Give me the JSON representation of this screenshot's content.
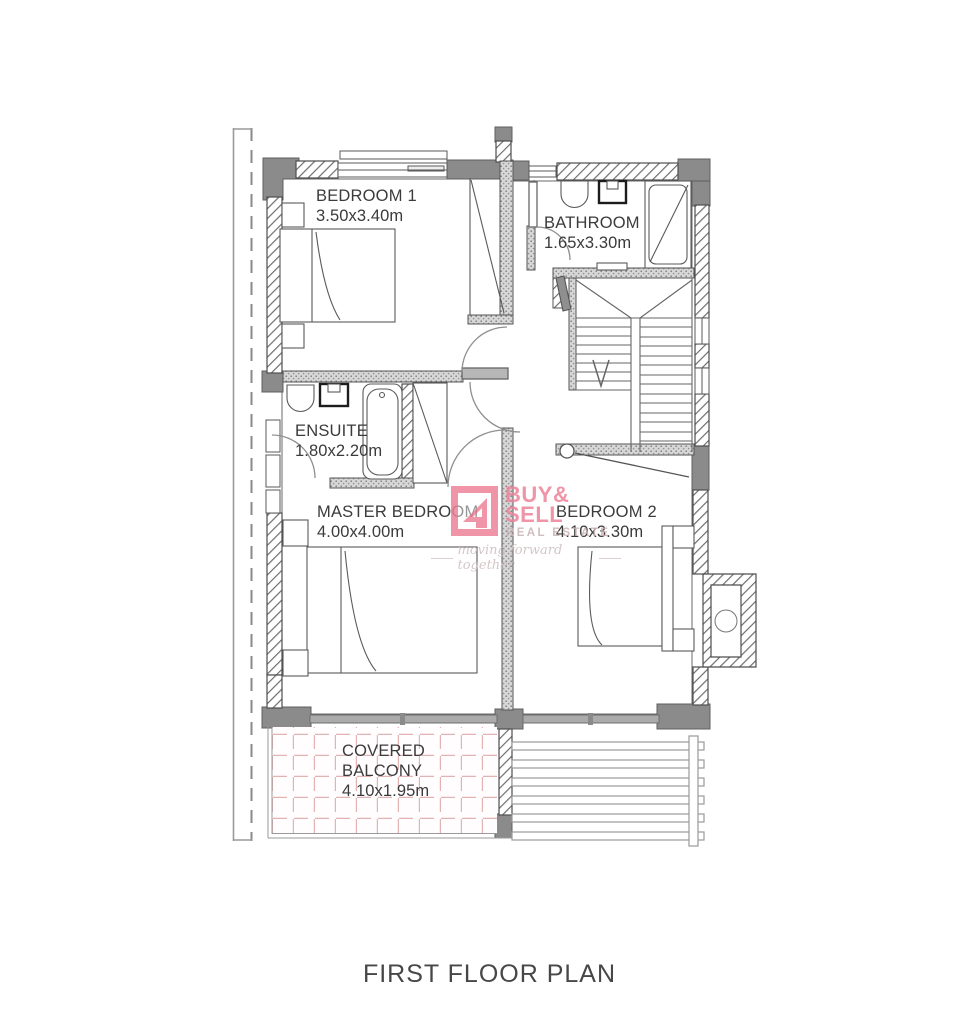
{
  "title": "FIRST FLOOR PLAN",
  "rooms": {
    "bedroom1": {
      "name": "BEDROOM 1",
      "dims": "3.50x3.40m"
    },
    "bathroom": {
      "name": "BATHROOM",
      "dims": "1.65x3.30m"
    },
    "ensuite": {
      "name": "ENSUITE",
      "dims": "1.80x2.20m"
    },
    "master": {
      "name": "MASTER BEDROOM",
      "dims": "4.00x4.00m"
    },
    "bedroom2": {
      "name": "BEDROOM 2",
      "dims": "4.10x3.30m"
    },
    "balcony": {
      "name": "COVERED BALCONY",
      "dims": "4.10x1.95m"
    }
  },
  "logo": {
    "word1": "BUY&",
    "word2": "SELL",
    "word3": "REAL ESTATE",
    "tagline": "moving forward together",
    "accent": "#ee8398",
    "muted": "#c9b2b4"
  },
  "colors": {
    "wall_solid": "#8b8b8b",
    "wall_line": "#5a5a5a",
    "balcony_grid": "#e2b3b3"
  }
}
